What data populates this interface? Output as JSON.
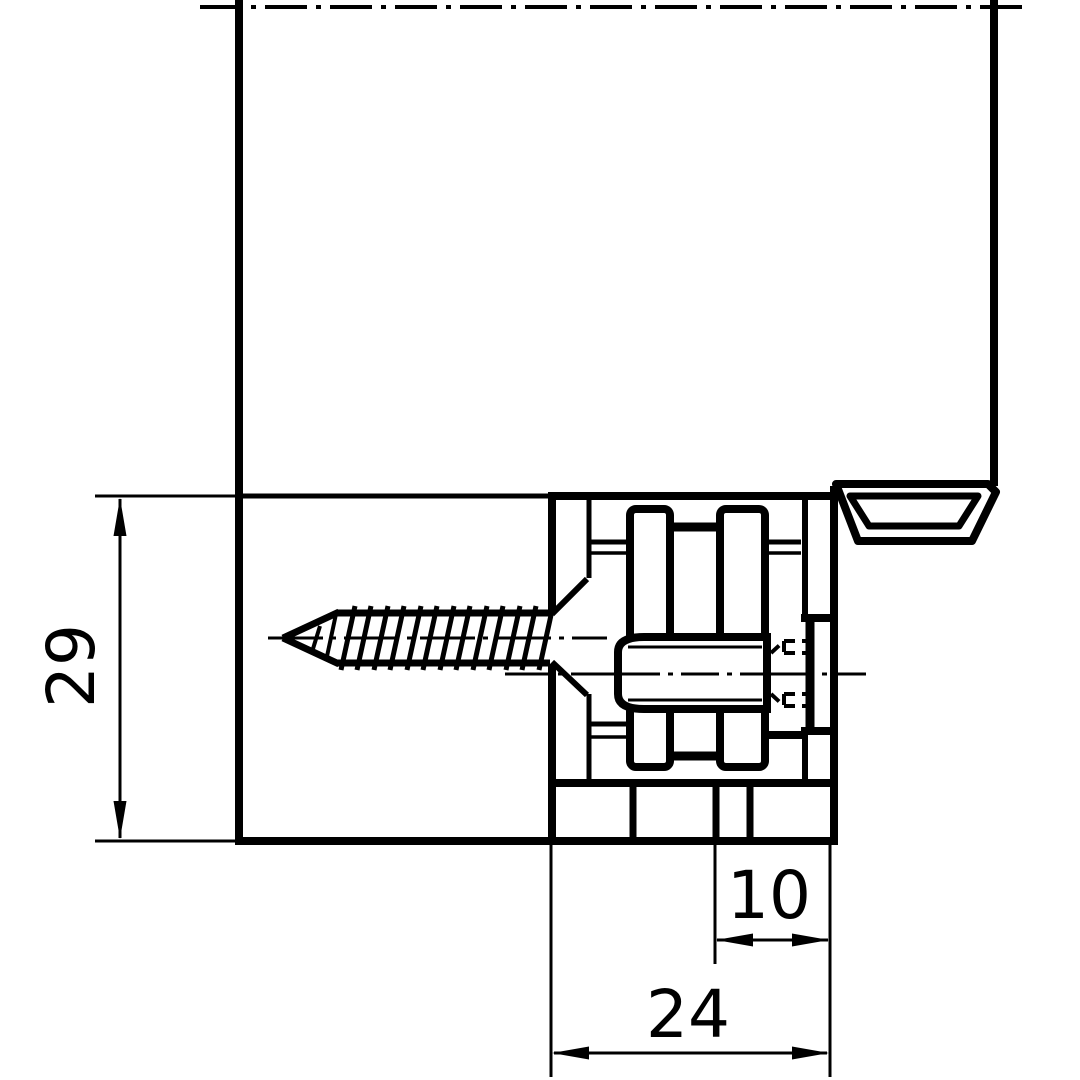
{
  "drawing": {
    "type": "technical-section-drawing",
    "background_color": "#ffffff",
    "line_color": "#000000",
    "dimensions": {
      "height": {
        "label": "29",
        "orientation": "vertical"
      },
      "inset": {
        "label": "10",
        "orientation": "horizontal"
      },
      "width": {
        "label": "24",
        "orientation": "horizontal"
      }
    }
  }
}
